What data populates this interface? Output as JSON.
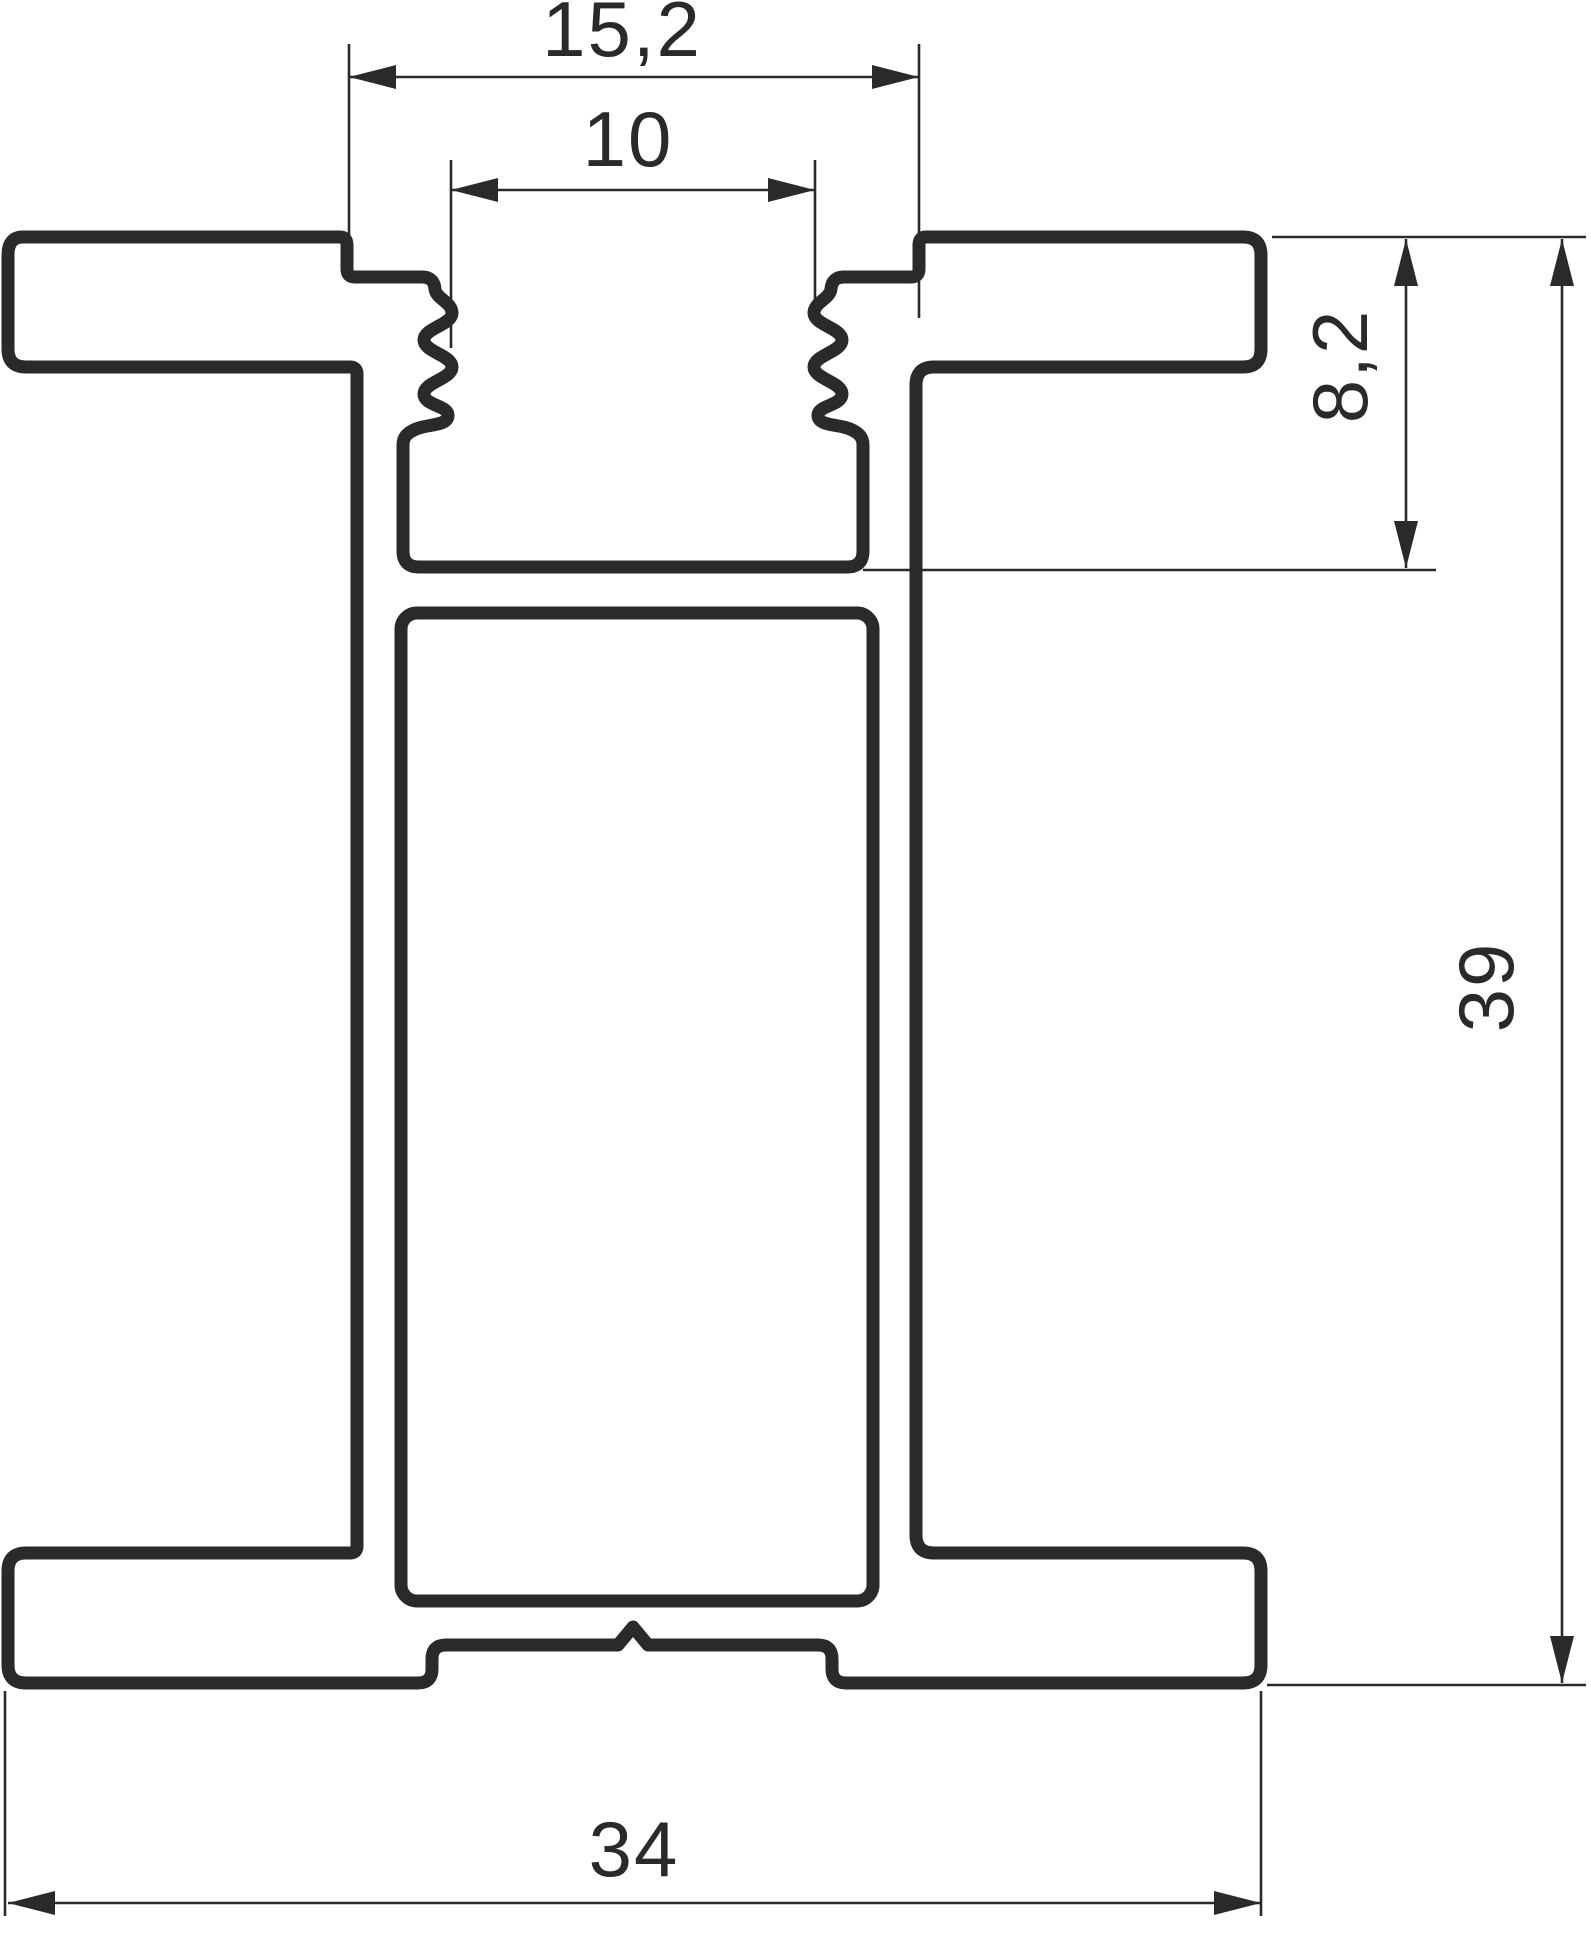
{
  "drawing": {
    "description": "Aluminium profile cross-section technical drawing",
    "line_color": "#2b2a29",
    "background_color": "#ffffff",
    "dimensions": {
      "top_opening_width": {
        "label": "15,2",
        "orientation": "horizontal"
      },
      "channel_width": {
        "label": "10",
        "orientation": "horizontal"
      },
      "channel_depth": {
        "label": "8,2",
        "orientation": "vertical"
      },
      "total_height": {
        "label": "39",
        "orientation": "vertical"
      },
      "total_width": {
        "label": "34",
        "orientation": "horizontal"
      }
    }
  }
}
